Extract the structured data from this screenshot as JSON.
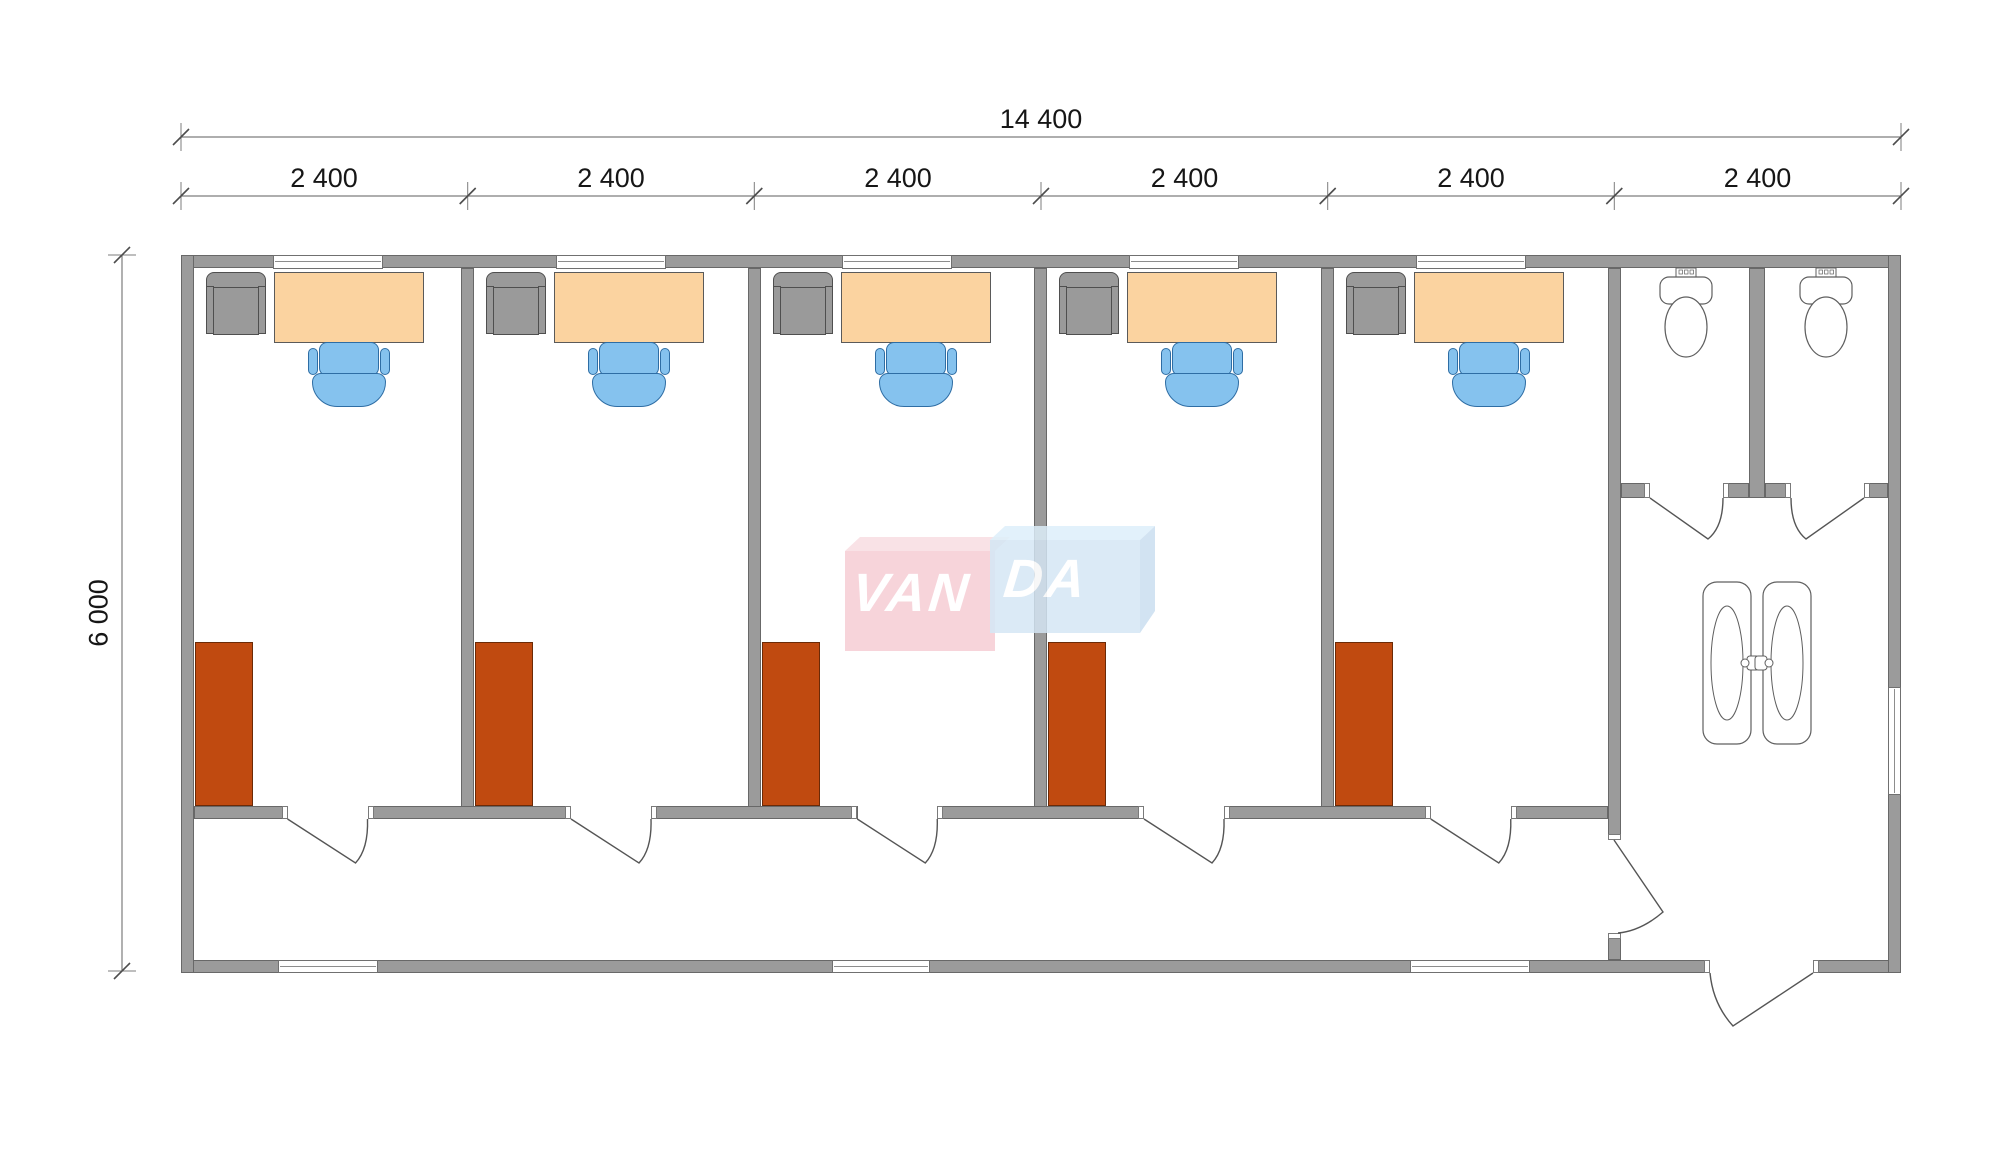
{
  "dims": {
    "total_width": "14 400",
    "segments": [
      "2 400",
      "2 400",
      "2 400",
      "2 400",
      "2 400",
      "2 400"
    ],
    "height": "6 000"
  },
  "watermark": {
    "left": "VAN",
    "right": "DA",
    "full": "VANDA"
  },
  "colors": {
    "wall": "#9b9b9b",
    "wall_edge": "#686868",
    "dim_line": "#7d7d7d",
    "text": "#161616",
    "desk": "#fbd3a0",
    "desk_edge": "#5a5a5a",
    "chair": "#85c2ee",
    "chair_edge": "#2e6da4",
    "guest_chair": "#9a9a9a",
    "guest_chair_edge": "#4f4f4f",
    "wardrobe": "#c04a10",
    "wardrobe_edge": "#6b2a07",
    "fixture_edge": "#5f5f5f",
    "door_line": "#555555",
    "logo_pink": "#f6cdd5",
    "logo_pink_top": "#f8dde3",
    "logo_blue": "#d4e5f4",
    "logo_blue_top": "#ddeefa",
    "logo_blue_side": "#c9def0"
  }
}
